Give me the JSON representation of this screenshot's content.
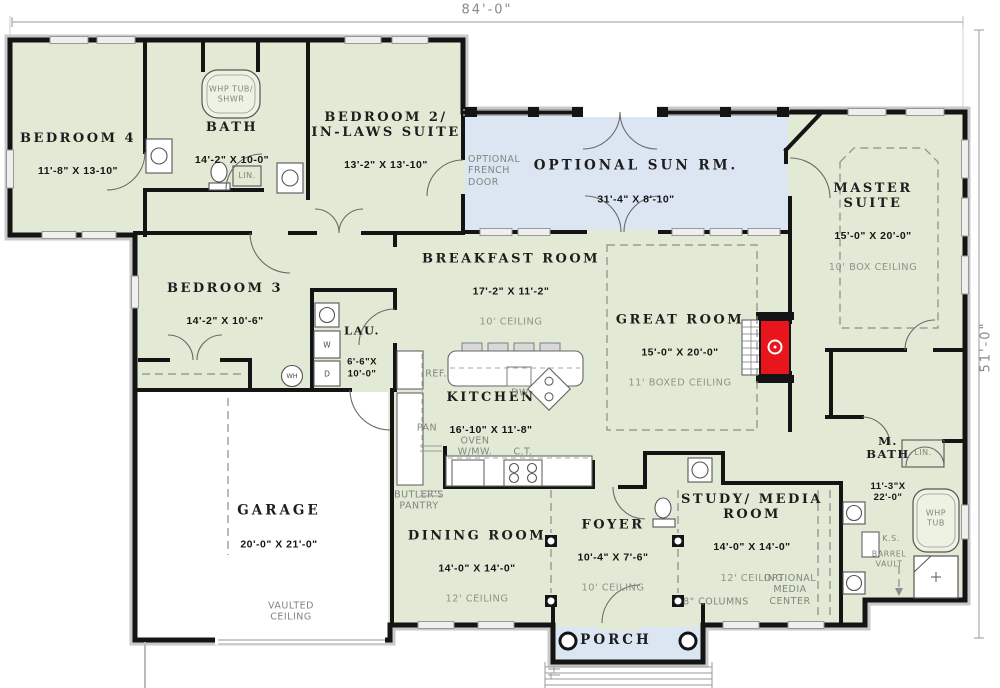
{
  "dimensions": {
    "overall_width": "84'-0\"",
    "overall_depth": "51'-0\""
  },
  "colors": {
    "room_fill": "#e2e9d4",
    "sun_porch_fill": "#dce6f3",
    "garage_fill": "#ffffff",
    "wall": "#141414",
    "fireplace_red": "#e8151d",
    "note_gray": "#8d948b",
    "dim_gray": "#8a8a8a"
  },
  "rooms": {
    "bedroom4": {
      "name": "BEDROOM 4",
      "dims": "11'-8\" X 13-10\""
    },
    "bath": {
      "name": "BATH",
      "dims": "14'-2\" X 10-0\""
    },
    "bedroom2": {
      "name": "BEDROOM 2/\nIN-LAWS SUITE",
      "dims": "13'-2\" X 13'-10\""
    },
    "sunroom": {
      "name": "OPTIONAL SUN RM.",
      "dims": "31'-4\" X 8'-10\""
    },
    "master": {
      "name": "MASTER\nSUITE",
      "dims": "15'-0\" X 20'-0\"",
      "note": "10' BOX CEILING"
    },
    "bedroom3": {
      "name": "BEDROOM 3",
      "dims": "14'-2\" X 10'-6\""
    },
    "laundry": {
      "name": "LAU.",
      "dims": "6'-6\"X\n10'-0\""
    },
    "breakfast": {
      "name": "BREAKFAST ROOM",
      "dims": "17'-2\" X 11'-2\"",
      "note": "10' CEILING"
    },
    "greatroom": {
      "name": "GREAT ROOM",
      "dims": "15'-0\" X 20'-0\"",
      "note": "11' BOXED CEILING"
    },
    "kitchen": {
      "name": "KITCHEN",
      "dims": "16'-10\" X 11'-8\""
    },
    "garage": {
      "name": "GARAGE",
      "dims": "20'-0\" X 21'-0\""
    },
    "dining": {
      "name": "DINING ROOM",
      "dims": "14'-0\" X 14'-0\"",
      "note": "12' CEILING"
    },
    "foyer": {
      "name": "FOYER",
      "dims": "10'-4\" X 7'-6\"",
      "note": "10' CEILING"
    },
    "study": {
      "name": "STUDY/ MEDIA\nROOM",
      "dims": "14'-0\" X 14'-0\"",
      "note": "12' CEILING"
    },
    "mbath": {
      "name": "M.\nBATH",
      "dims": "11'-3\"X\n22'-0\""
    },
    "porch": {
      "name": "PORCH"
    }
  },
  "annotations": {
    "whp_tub_shwr": "WHP TUB/\nSHWR",
    "lin_bath": "LIN.",
    "optional_french_door": "OPTIONAL\nFRENCH\nDOOR",
    "ref": "REF.",
    "pan": "PAN",
    "dw": "DW",
    "oven": "OVEN\nW/MW.",
    "ct": "C.T.",
    "butlers_pantry": "BUTLER'S\nPANTRY",
    "vaulted_ceiling": "VAULTED\nCEILING",
    "optional_media_center": "OPTIONAL\nMEDIA\nCENTER",
    "columns": "8\" COLUMNS",
    "lin_mbath": "LIN.",
    "whp_tub": "WHP\nTUB",
    "ks": "K.S.",
    "barrel_vault": "BARREL\nVAULT",
    "wh": "WH",
    "washer": "W",
    "dryer": "D"
  }
}
